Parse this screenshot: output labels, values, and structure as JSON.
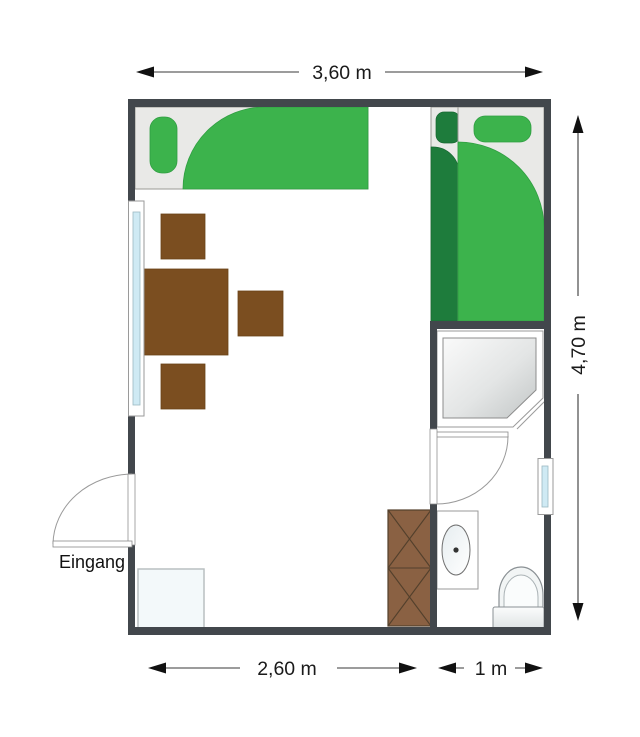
{
  "labels": {
    "entrance": "Eingang"
  },
  "dimensions": {
    "top_width": "3,60 m",
    "right_height": "4,70 m",
    "bottom_main_room": "2,60 m",
    "bottom_bathroom": "1 m"
  },
  "colors": {
    "wall": "#42474c",
    "bed_base": "#e9e9e7",
    "bedding_green": "#3cb34c",
    "bedding_dark_green": "#1e7c3c",
    "wood_brown": "#7b4e20",
    "cabinet_brown": "#8a6143",
    "window_glass": "#cfeaf4",
    "light_furniture": "#f3f9fa"
  }
}
